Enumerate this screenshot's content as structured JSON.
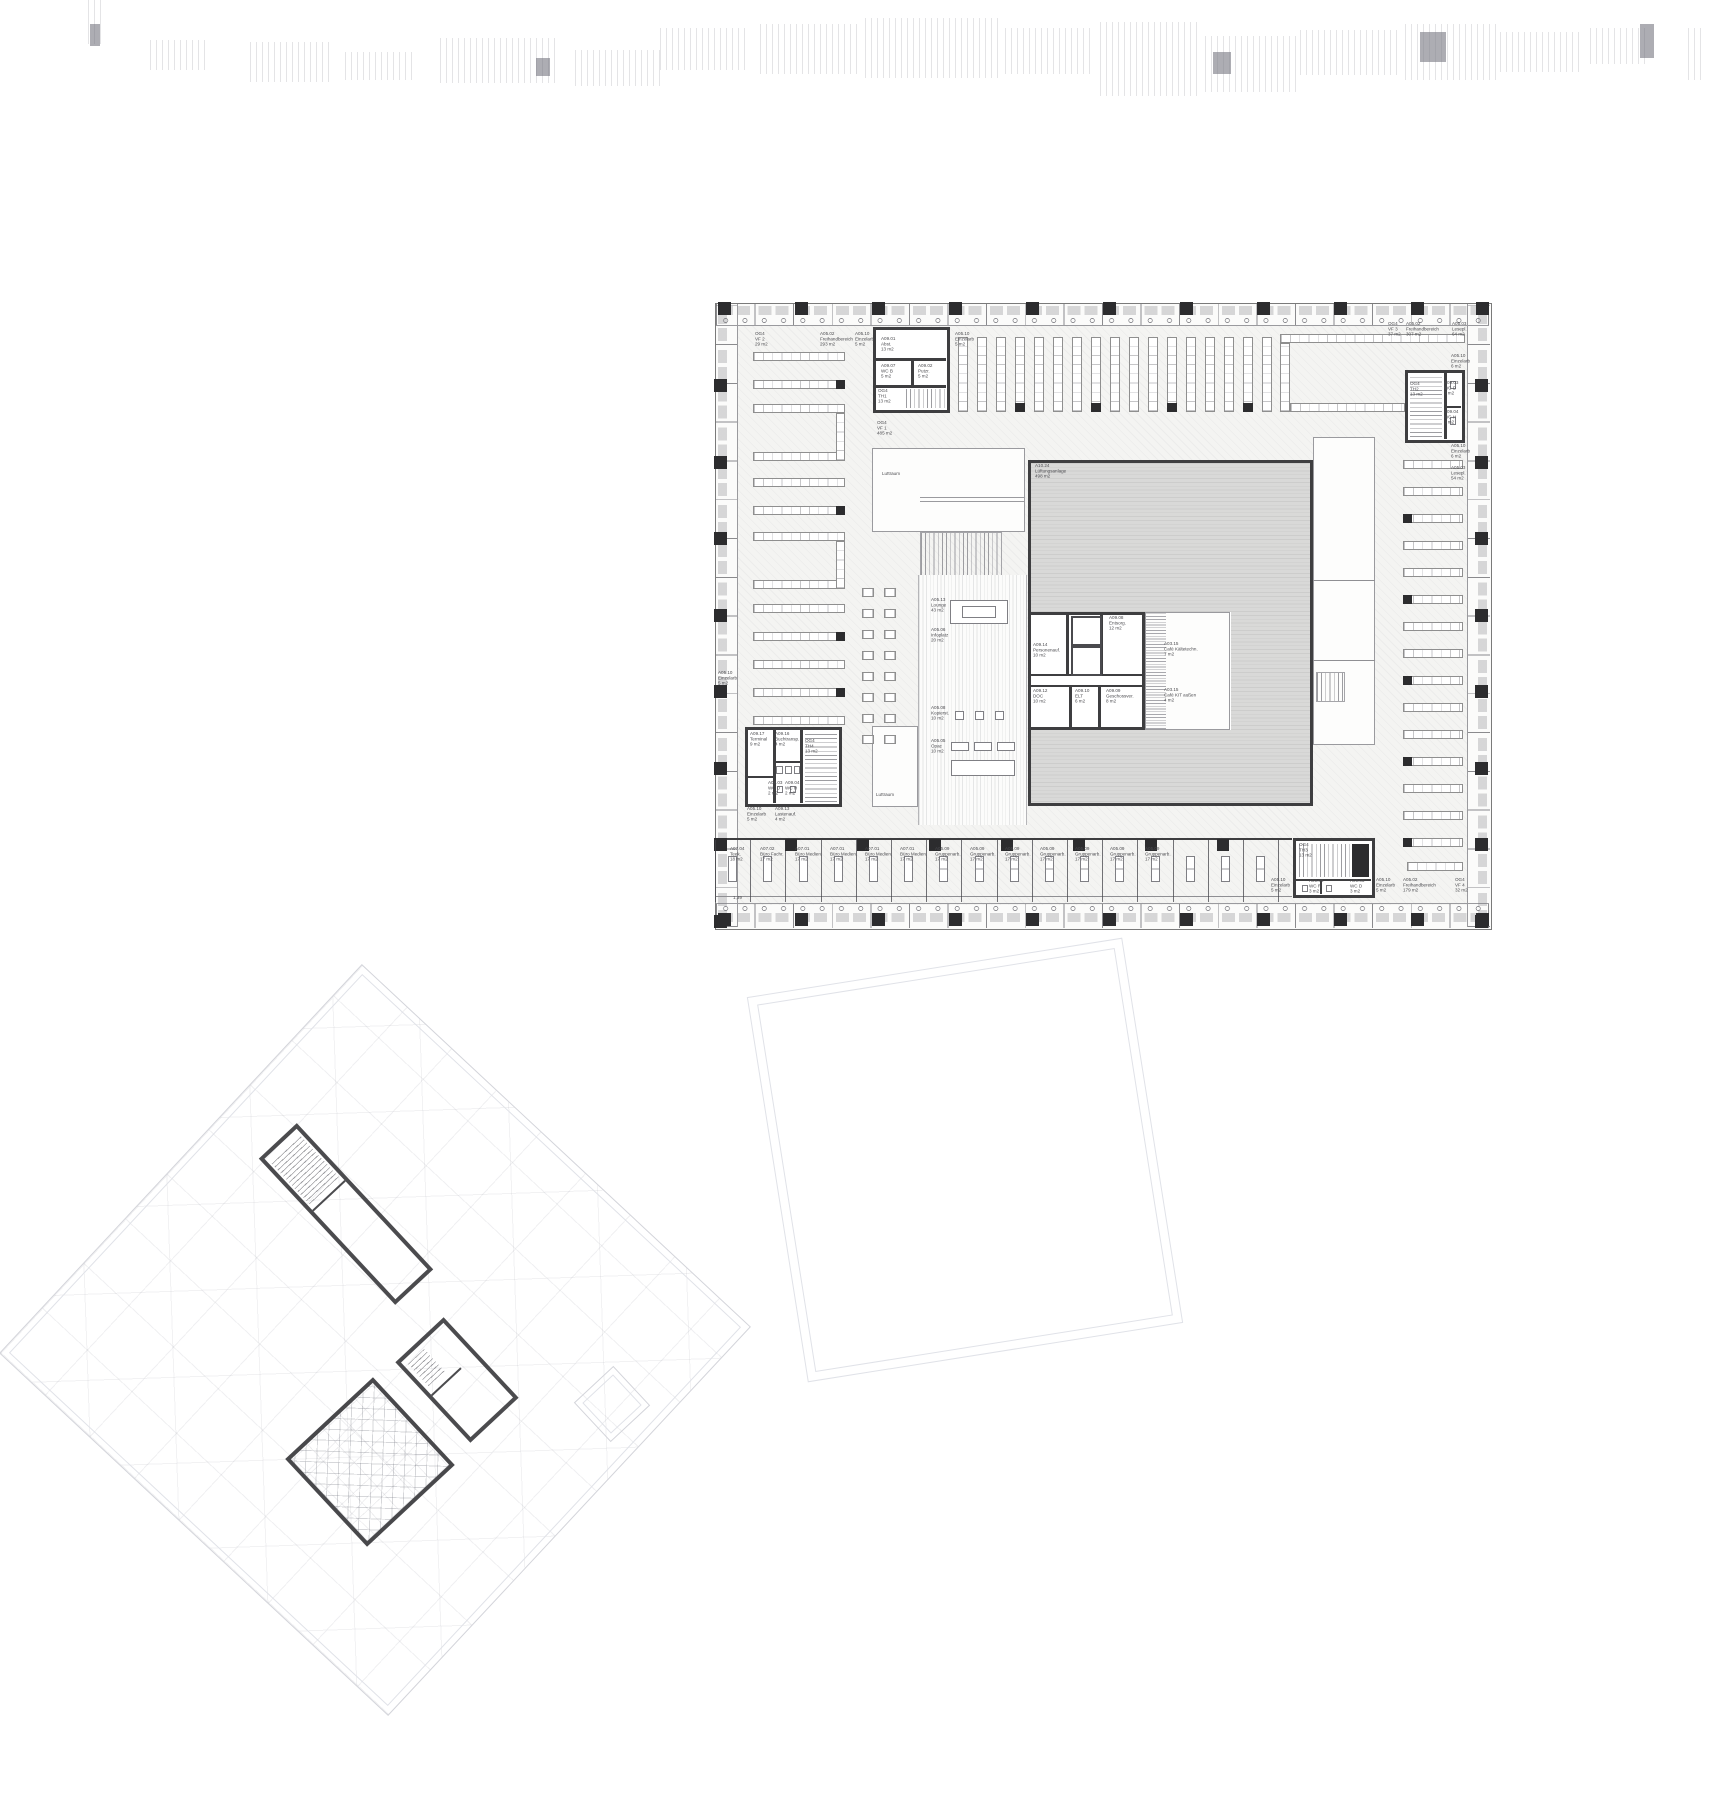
{
  "labels": [
    {
      "code": "OG4",
      "name": "VF 2",
      "area": "29 m2",
      "x": 755,
      "y": 332
    },
    {
      "code": "A05.02",
      "name": "Freihandbereich",
      "area": "293 m2",
      "x": 820,
      "y": 332
    },
    {
      "code": "A05.10",
      "name": "Einzelarb",
      "area": "5 m2",
      "x": 855,
      "y": 332
    },
    {
      "code": "A05.10",
      "name": "Einzelarb",
      "area": "5 m2",
      "x": 955,
      "y": 332
    },
    {
      "code": "A09.01",
      "name": "Abst.",
      "area": "13 m2",
      "x": 881,
      "y": 337
    },
    {
      "code": "A09.07",
      "name": "WC B",
      "area": "5 m2",
      "x": 881,
      "y": 364
    },
    {
      "code": "A09.02",
      "name": "Putzr.",
      "area": "5 m2",
      "x": 918,
      "y": 364
    },
    {
      "code": "OG4",
      "name": "TH1",
      "area": "13 m2",
      "x": 878,
      "y": 389
    },
    {
      "code": "OG4",
      "name": "VF 1",
      "area": "485 m2",
      "x": 877,
      "y": 421
    },
    {
      "code": "OG4",
      "name": "VF 3",
      "area": "37 m2",
      "x": 1388,
      "y": 322
    },
    {
      "code": "A05.02",
      "name": "Freihandbereich",
      "area": "307 m2",
      "x": 1406,
      "y": 322
    },
    {
      "code": "A05.03",
      "name": "Lesepl.",
      "area": "64 m2",
      "x": 1452,
      "y": 322
    },
    {
      "code": "A05.10",
      "name": "Einzelarb",
      "area": "6 m2",
      "x": 1451,
      "y": 354
    },
    {
      "code": "OG4",
      "name": "TH2",
      "area": "13 m2",
      "x": 1410,
      "y": 382
    },
    {
      "code": "A09.03",
      "name": "WC D",
      "area": "3 m2",
      "x": 1444,
      "y": 381
    },
    {
      "code": "A09.04",
      "name": "WC H",
      "area": "3 m2",
      "x": 1444,
      "y": 410
    },
    {
      "code": "A05.10",
      "name": "Einzelarb",
      "area": "6 m2",
      "x": 1451,
      "y": 444
    },
    {
      "code": "A05.03",
      "name": "Lesepl.",
      "area": "54 m2",
      "x": 1451,
      "y": 466
    },
    {
      "code": "A10.24",
      "name": "Lüftungsanlage",
      "area": "498 m2",
      "x": 1035,
      "y": 464
    },
    {
      "name": "Luftraum",
      "x": 882,
      "y": 472
    },
    {
      "code": "A05.13",
      "name": "Lounge",
      "area": "43 m2",
      "x": 931,
      "y": 598
    },
    {
      "code": "A05.06",
      "name": "Infoplatz",
      "area": "20 m2",
      "x": 931,
      "y": 628
    },
    {
      "code": "A09.14",
      "name": "Personenauf.",
      "area": "10 m2",
      "x": 1033,
      "y": 643
    },
    {
      "code": "A09.08",
      "name": "Entsorg.",
      "area": "12 m2",
      "x": 1109,
      "y": 616
    },
    {
      "code": "A03.15",
      "name": "Café Kältetechn.",
      "area": "7 m2",
      "x": 1164,
      "y": 642
    },
    {
      "code": "A09.12",
      "name": "DOC",
      "area": "10 m2",
      "x": 1033,
      "y": 689
    },
    {
      "code": "A09.10",
      "name": "ELT",
      "area": "6 m2",
      "x": 1075,
      "y": 689
    },
    {
      "code": "A09.09",
      "name": "Geschossver.",
      "area": "8 m2",
      "x": 1106,
      "y": 689
    },
    {
      "code": "A03.15",
      "name": "Café KIT außen",
      "area": "4 m2",
      "x": 1164,
      "y": 688
    },
    {
      "code": "A05.08",
      "name": "Kopierst.",
      "area": "10 m2",
      "x": 931,
      "y": 706
    },
    {
      "code": "A05.05",
      "name": "Opac",
      "area": "10 m2",
      "x": 931,
      "y": 739
    },
    {
      "name": "Luftraum",
      "x": 876,
      "y": 793
    },
    {
      "code": "A05.10",
      "name": "Einzelarb",
      "area": "5 m2",
      "x": 718,
      "y": 671
    },
    {
      "code": "A09.17",
      "name": "Terminal",
      "area": "9 m2",
      "x": 750,
      "y": 732
    },
    {
      "code": "A09.16",
      "name": "Buchtransp.",
      "area": "4 m2",
      "x": 775,
      "y": 732
    },
    {
      "code": "OG4",
      "name": "TH4",
      "area": "13 m2",
      "x": 805,
      "y": 739
    },
    {
      "code": "A09.03",
      "name": "WC D",
      "area": "2 m2",
      "x": 768,
      "y": 781
    },
    {
      "code": "A09.04",
      "name": "WC H",
      "area": "2 m2",
      "x": 785,
      "y": 781
    },
    {
      "code": "A05.10",
      "name": "Einzelarb",
      "area": "5 m2",
      "x": 747,
      "y": 807
    },
    {
      "code": "A09.13",
      "name": "Lastenauf.",
      "area": "4 m2",
      "x": 775,
      "y": 807
    },
    {
      "code": "A07.04",
      "name": "Teek.",
      "area": "18 m2",
      "x": 730,
      "y": 847
    },
    {
      "code": "A07.02",
      "name": "Büro Fachr.",
      "area": "17 m2",
      "x": 760,
      "y": 847
    },
    {
      "code": "A07.01",
      "name": "Büro Medien.",
      "area": "17 m2",
      "x": 795,
      "y": 847
    },
    {
      "code": "A07.01",
      "name": "Büro Medien.",
      "area": "17 m2",
      "x": 830,
      "y": 847
    },
    {
      "code": "A07.01",
      "name": "Büro Medien.",
      "area": "17 m2",
      "x": 865,
      "y": 847
    },
    {
      "code": "A07.01",
      "name": "Büro Medien.",
      "area": "17 m2",
      "x": 900,
      "y": 847
    },
    {
      "code": "A05.09",
      "name": "Gruppenarb.",
      "area": "17 m2",
      "x": 935,
      "y": 847
    },
    {
      "code": "A05.09",
      "name": "Gruppenarb.",
      "area": "17 m2",
      "x": 970,
      "y": 847
    },
    {
      "code": "A05.09",
      "name": "Gruppenarb.",
      "area": "17 m2",
      "x": 1005,
      "y": 847
    },
    {
      "code": "A05.09",
      "name": "Gruppenarb.",
      "area": "17 m2",
      "x": 1040,
      "y": 847
    },
    {
      "code": "A05.09",
      "name": "Gruppenarb.",
      "area": "17 m2",
      "x": 1075,
      "y": 847
    },
    {
      "code": "A05.09",
      "name": "Gruppenarb.",
      "area": "17 m2",
      "x": 1110,
      "y": 847
    },
    {
      "code": "A05.09",
      "name": "Gruppenarb.",
      "area": "17 m2",
      "x": 1145,
      "y": 847
    },
    {
      "code": "OG4",
      "name": "TH3",
      "area": "13 m2",
      "x": 1299,
      "y": 843
    },
    {
      "code": "A05.10",
      "name": "Einzelarb",
      "area": "5 m2",
      "x": 1271,
      "y": 878
    },
    {
      "code": "A09.06",
      "name": "WC R",
      "area": "3 m2",
      "x": 1309,
      "y": 879
    },
    {
      "code": "A09.05",
      "name": "WC D",
      "area": "3 m2",
      "x": 1350,
      "y": 879
    },
    {
      "code": "A05.10",
      "name": "Einzelarb",
      "area": "5 m2",
      "x": 1376,
      "y": 878
    },
    {
      "code": "A05.02",
      "name": "Freihandbereich",
      "area": "179 m2",
      "x": 1403,
      "y": 878
    },
    {
      "code": "OG4",
      "name": "VF 4",
      "area": "32 m2",
      "x": 1455,
      "y": 878
    },
    {
      "name": "1,39",
      "x": 733,
      "y": 896
    }
  ]
}
